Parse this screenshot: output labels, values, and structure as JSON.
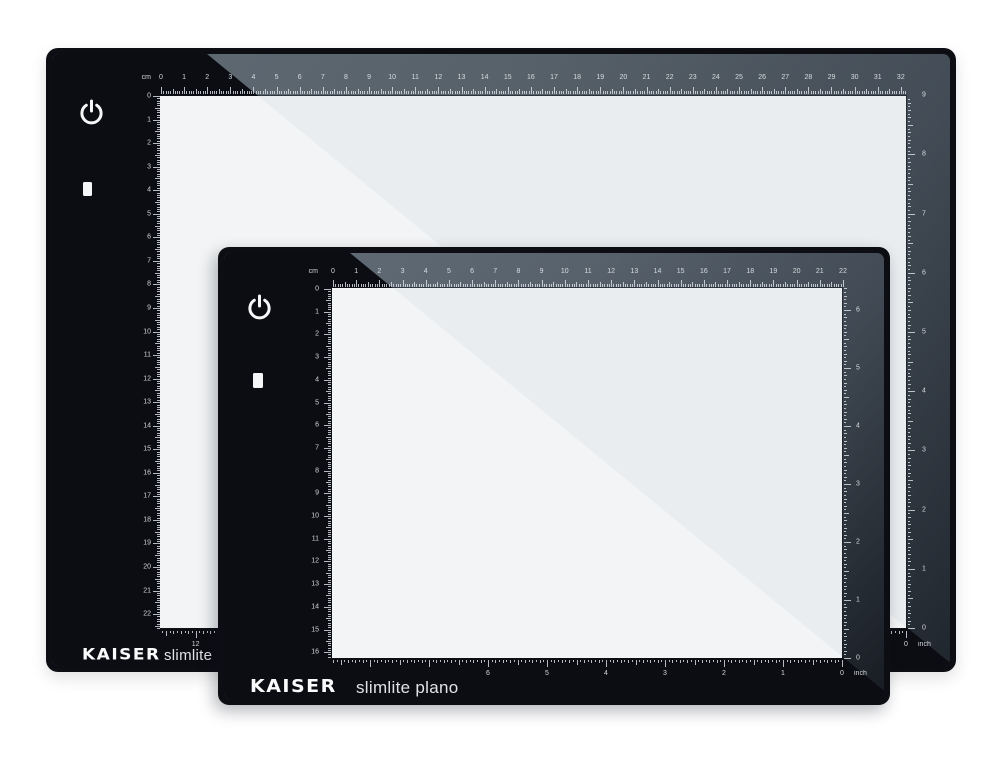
{
  "page": {
    "description": "Two KAISER slimlite plano LED light boxes, large behind and small in front",
    "background": "#ffffff"
  },
  "colors": {
    "frame_black": "#0d0e13",
    "glass_reflection_gray": "#5e6973",
    "glass_reflection_dark": "#1d222a",
    "screen_white": "#eaedef",
    "screen_highlight": "#f2f4f5",
    "ruler_marks": "#dfe4e8",
    "logo_white": "#fafbfc"
  },
  "panels": {
    "large": {
      "logo_brand": "KAISER",
      "logo_model": "slimlite",
      "unit_cm": "cm",
      "unit_inch": "inch",
      "rulers": {
        "top_cm_values": [
          0,
          1,
          2,
          3,
          4,
          5,
          6,
          7,
          8,
          9,
          10,
          11,
          12,
          13,
          14,
          15,
          16,
          17,
          18,
          19,
          20,
          21,
          22,
          23,
          24,
          25,
          26,
          27,
          28,
          29,
          30,
          31,
          32
        ],
        "left_cm_values": [
          0,
          1,
          2,
          3,
          4,
          5,
          6,
          7,
          8,
          9,
          10,
          11,
          12,
          13,
          14,
          15,
          16,
          17,
          18,
          19,
          20,
          21,
          22
        ],
        "right_inch_values": [
          9,
          8,
          7,
          6,
          5,
          4,
          3,
          2,
          1,
          0
        ],
        "bottom_inch_values": [
          0,
          1,
          2,
          3,
          4,
          5,
          6,
          7,
          8,
          9,
          10,
          11,
          12
        ]
      }
    },
    "small": {
      "logo_brand": "KAISER",
      "logo_model": "slimlite plano",
      "unit_cm": "cm",
      "unit_inch": "inch",
      "rulers": {
        "top_cm_values": [
          0,
          1,
          2,
          3,
          4,
          5,
          6,
          7,
          8,
          9,
          10,
          11,
          12,
          13,
          14,
          15,
          16,
          17,
          18,
          19,
          20,
          21,
          22
        ],
        "left_cm_values": [
          0,
          1,
          2,
          3,
          4,
          5,
          6,
          7,
          8,
          9,
          10,
          11,
          12,
          13,
          14,
          15,
          16
        ],
        "right_inch_values": [
          6,
          5,
          4,
          3,
          2,
          1,
          0
        ],
        "bottom_inch_values": [
          0,
          1,
          2,
          3,
          4,
          5,
          6
        ]
      }
    }
  }
}
